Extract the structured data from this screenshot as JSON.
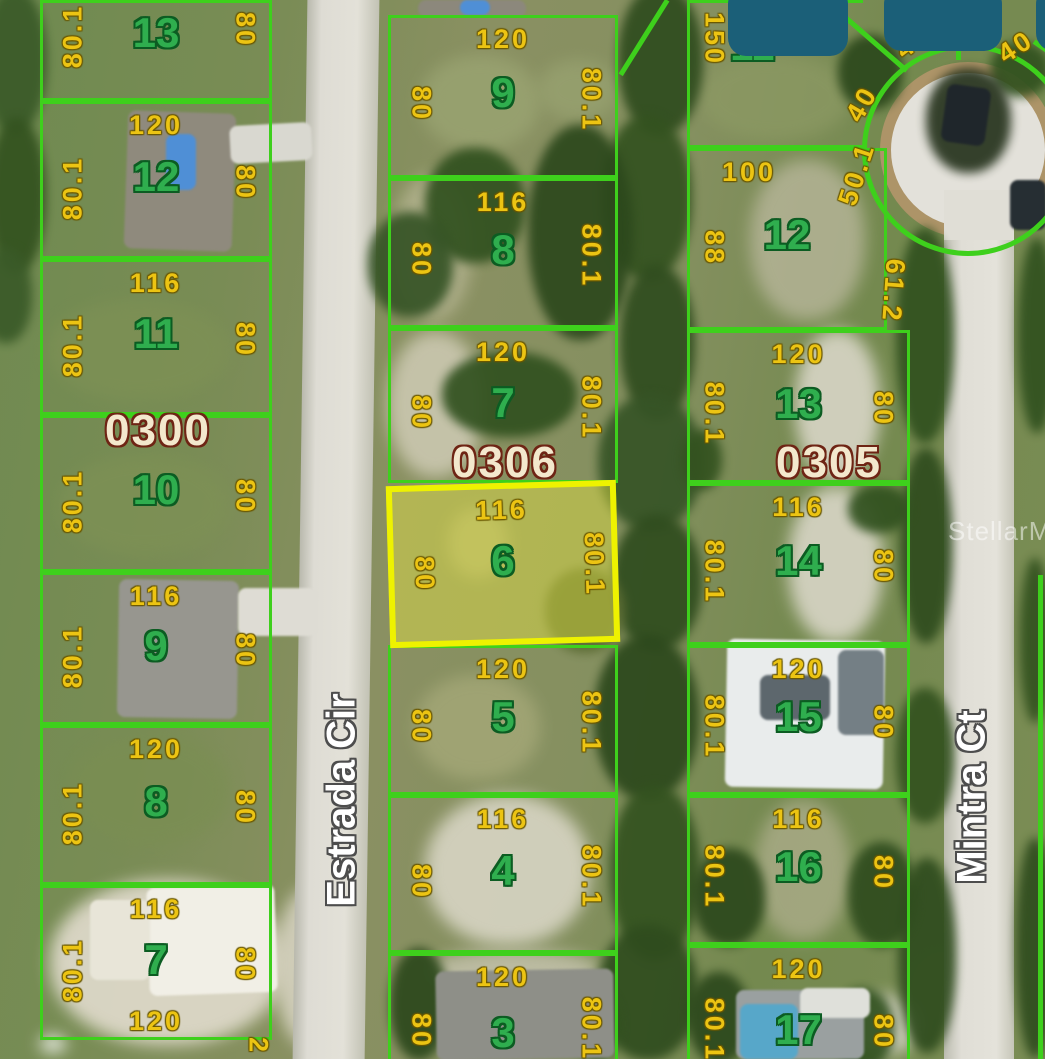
{
  "app": {
    "watermark": "StellarMLS"
  },
  "streets": {
    "estrada": "Estrada Cir",
    "mintra": "Mintra Ct"
  },
  "blocks": {
    "b0300": "0300",
    "b0306": "0306",
    "b0305": "0305"
  },
  "colors": {
    "border_green": "#3ed01c",
    "highlight_yellow": "#eef200",
    "dim_yellow": "#ecc413",
    "lot_green": "#2fae4e",
    "block_cream": "#f3e8cd",
    "redaction_teal": "#1b5f78"
  },
  "lots": {
    "left": [
      {
        "number": "13",
        "left": "80.1",
        "right": "80"
      },
      {
        "number": "12",
        "top": "120",
        "left": "80.1",
        "right": "80"
      },
      {
        "number": "11",
        "top": "116",
        "left": "80.1",
        "right": "80"
      },
      {
        "number": "10",
        "left": "80.1",
        "right": "80"
      },
      {
        "number": "9",
        "top": "116",
        "left": "80.1",
        "right": "80"
      },
      {
        "number": "8",
        "top": "120",
        "left": "80.1",
        "right": "80"
      },
      {
        "number": "7",
        "top": "116",
        "left": "80.1",
        "right": "80",
        "bottom": "120"
      }
    ],
    "middle": [
      {
        "number": "9",
        "top": "120",
        "left": "80",
        "right": "80.1"
      },
      {
        "number": "8",
        "top": "116",
        "left": "80",
        "right": "80.1"
      },
      {
        "number": "7",
        "top": "120",
        "left": "80",
        "right": "80.1"
      },
      {
        "number": "6",
        "top": "116",
        "left": "80",
        "right": "80.1",
        "highlighted": true
      },
      {
        "number": "5",
        "top": "120",
        "left": "80",
        "right": "80.1"
      },
      {
        "number": "4",
        "top": "116",
        "left": "80",
        "right": "80.1"
      },
      {
        "number": "3",
        "top": "120",
        "left": "80",
        "right": "80.1"
      }
    ],
    "right": [
      {
        "number": "11",
        "left": "150"
      },
      {
        "number": "12",
        "top": "100",
        "left": "88"
      },
      {
        "number": "13",
        "top": "120",
        "left": "80.1",
        "right": "80"
      },
      {
        "number": "14",
        "top": "116",
        "left": "80.1",
        "right": "80"
      },
      {
        "number": "15",
        "top": "120",
        "left": "80.1",
        "right": "80"
      },
      {
        "number": "16",
        "top": "116",
        "left": "80.1",
        "right": "80"
      },
      {
        "number": "17",
        "top": "120",
        "left": "80.1",
        "right": "80"
      }
    ]
  },
  "edge_labels": {
    "d40a": "40",
    "d40b": "40",
    "d40c": "40",
    "d50": "50.1",
    "d61": "61.2",
    "d2": "2"
  }
}
